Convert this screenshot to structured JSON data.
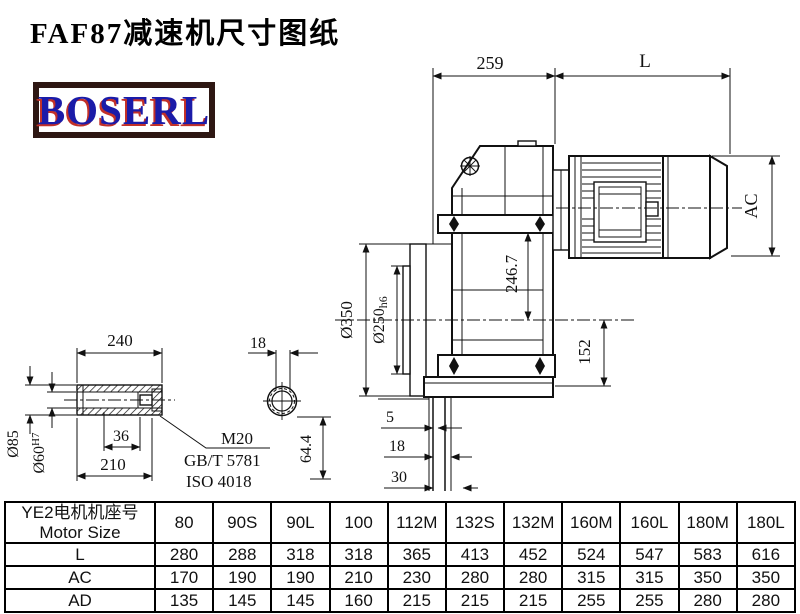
{
  "page": {
    "title": "FAF87减速机尺寸图纸",
    "logo_text": "BOSERL"
  },
  "colors": {
    "line": "#111111",
    "logo_border": "#2e1713",
    "logo_blue": "#1b1ba8",
    "logo_red": "#c23028"
  },
  "drawing": {
    "dims": {
      "width_259": "259",
      "motor_length": "L",
      "motor_diameter": "AC",
      "center_height": "246.7",
      "flange_diameter": "Ø350",
      "spigot_diameter": "Ø250",
      "spigot_tolerance": "h6",
      "output_center_height": "152",
      "offset_5": "5",
      "offset_18": "18",
      "offset_30": "30",
      "shaft_offset": "64.4",
      "shaft_length": "240",
      "slot_width": "18",
      "hub_diameter": "Ø85",
      "bore_diameter": "Ø60",
      "bore_tolerance": "H7",
      "hub_step": "36",
      "shaft_inner_length": "210",
      "thread_spec": "M20",
      "standard_gb": "GB/T 5781",
      "standard_iso": "ISO 4018"
    }
  },
  "table": {
    "header_cn": "YE2电机机座号",
    "header_en": "Motor Size",
    "columns": [
      "80",
      "90S",
      "90L",
      "100",
      "112M",
      "132S",
      "132M",
      "160M",
      "160L",
      "180M",
      "180L"
    ],
    "rows": [
      {
        "label": "L",
        "values": [
          "280",
          "288",
          "318",
          "318",
          "365",
          "413",
          "452",
          "524",
          "547",
          "583",
          "616"
        ]
      },
      {
        "label": "AC",
        "values": [
          "170",
          "190",
          "190",
          "210",
          "230",
          "280",
          "280",
          "315",
          "315",
          "350",
          "350"
        ]
      },
      {
        "label": "AD",
        "values": [
          "135",
          "145",
          "145",
          "160",
          "215",
          "215",
          "215",
          "255",
          "255",
          "280",
          "280"
        ]
      }
    ]
  }
}
